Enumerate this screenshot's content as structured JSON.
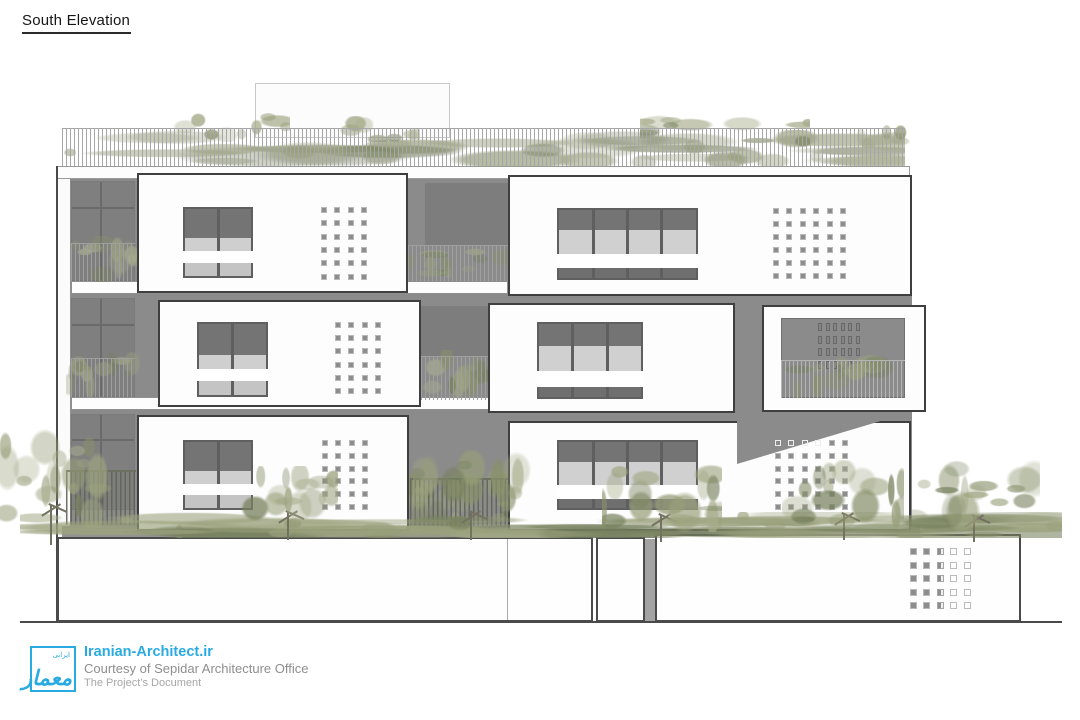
{
  "title": "South Elevation",
  "footer": {
    "site": "Iranian-Architect.ir",
    "courtesy": "Courtesy of Sepidar Architecture Office",
    "doc_label": "The Project’s Document",
    "logo_main": "معمار",
    "logo_small": "ایرانی"
  },
  "colors": {
    "accent": "#29abe2",
    "facade_gray": "#8b8b8b",
    "glazing_dark": "#747474",
    "glazing_light": "#d0d0d0",
    "panel_white": "#fdfdfd",
    "outline_dark": "#3f3f3f",
    "vegetation_olive": "#9aa17b",
    "ink": "#161616",
    "text_gray": "#8e8e8e",
    "text_light": "#a6a6a6"
  },
  "elevation": {
    "items": [
      {
        "t": "rect",
        "n": "roof-bulkhead",
        "x": 255,
        "y": 83,
        "w": 195,
        "h": 55,
        "f": "#fcfcfc",
        "s": "#c8c8c8",
        "sw": 1
      },
      {
        "t": "veg",
        "n": "roof-planting",
        "x": 60,
        "y": 130,
        "w": 845,
        "h": 36,
        "seed": 11,
        "nb": 40
      },
      {
        "t": "veg",
        "n": "roof-planting-bump",
        "x": 160,
        "y": 112,
        "w": 130,
        "h": 30,
        "seed": 21,
        "nb": 9
      },
      {
        "t": "veg",
        "n": "roof-planting-bump",
        "x": 330,
        "y": 116,
        "w": 90,
        "h": 26,
        "seed": 41,
        "nb": 7
      },
      {
        "t": "veg",
        "n": "roof-planting-bump",
        "x": 640,
        "y": 106,
        "w": 170,
        "h": 42,
        "seed": 31,
        "nb": 11
      },
      {
        "t": "veg",
        "n": "roof-planting-bump",
        "x": 855,
        "y": 120,
        "w": 60,
        "h": 28,
        "seed": 51,
        "nb": 5
      },
      {
        "t": "rail",
        "n": "roof-railing",
        "x": 62,
        "y": 128,
        "w": 843,
        "h": 39,
        "sp": 4,
        "c": "#a6a6a6"
      },
      {
        "t": "rect",
        "n": "roof-parapet",
        "x": 57,
        "y": 166,
        "w": 853,
        "h": 13,
        "f": "#fdfdfd",
        "s": "#9a9a9a",
        "sw": 1
      },
      {
        "t": "rect",
        "n": "left-edge-line",
        "x": 56,
        "y": 166,
        "w": 2,
        "h": 456,
        "f": "#4a4a4a"
      },
      {
        "t": "rect",
        "n": "left-side-wall",
        "x": 58,
        "y": 179,
        "w": 12,
        "h": 443,
        "f": "#fbfbfb"
      },
      {
        "t": "rect",
        "n": "left-side-wall-line",
        "x": 70,
        "y": 179,
        "w": 1,
        "h": 443,
        "f": "#8f8f8f"
      },
      {
        "t": "rect",
        "n": "facade-wall",
        "x": 71,
        "y": 179,
        "w": 841,
        "h": 353,
        "f": "#8b8b8b"
      },
      {
        "t": "glazing",
        "n": "balcony-glazing",
        "x": 71,
        "y": 181,
        "w": 64,
        "h": 100
      },
      {
        "t": "glazing",
        "n": "balcony-glazing",
        "x": 71,
        "y": 298,
        "w": 64,
        "h": 99
      },
      {
        "t": "glazing",
        "n": "balcony-glazing",
        "x": 71,
        "y": 414,
        "w": 64,
        "h": 96
      },
      {
        "t": "rect",
        "n": "recess-glazing",
        "x": 425,
        "y": 183,
        "w": 83,
        "h": 62,
        "f": "#7d7d7d"
      },
      {
        "t": "rect",
        "n": "recess-glazing",
        "x": 421,
        "y": 306,
        "w": 67,
        "h": 50,
        "f": "#7d7d7d"
      },
      {
        "t": "rect",
        "n": "floor-slab",
        "x": 71,
        "y": 281,
        "w": 437,
        "h": 13,
        "f": "#fdfdfd",
        "s": "#8f8f8f",
        "sw": 1
      },
      {
        "t": "rect",
        "n": "floor-slab",
        "x": 71,
        "y": 397,
        "w": 437,
        "h": 13,
        "f": "#fdfdfd",
        "s": "#8f8f8f",
        "sw": 1
      },
      {
        "t": "veg",
        "n": "balcony-planting",
        "x": 66,
        "y": 236,
        "w": 76,
        "h": 46,
        "seed": 61,
        "nb": 12
      },
      {
        "t": "rail",
        "n": "balcony-railing",
        "x": 71,
        "y": 243,
        "w": 64,
        "h": 38,
        "sp": 4,
        "c": "#9f9f9f"
      },
      {
        "t": "veg",
        "n": "balcony-planting",
        "x": 406,
        "y": 246,
        "w": 104,
        "h": 36,
        "seed": 71,
        "nb": 12
      },
      {
        "t": "rail",
        "n": "balcony-railing",
        "x": 408,
        "y": 245,
        "w": 100,
        "h": 36,
        "sp": 4,
        "c": "#9f9f9f"
      },
      {
        "t": "veg",
        "n": "balcony-planting",
        "x": 66,
        "y": 352,
        "w": 76,
        "h": 46,
        "seed": 81,
        "nb": 12
      },
      {
        "t": "rail",
        "n": "balcony-railing",
        "x": 71,
        "y": 358,
        "w": 64,
        "h": 39,
        "sp": 4,
        "c": "#9f9f9f"
      },
      {
        "t": "veg",
        "n": "balcony-planting",
        "x": 419,
        "y": 350,
        "w": 72,
        "h": 50,
        "seed": 91,
        "nb": 12
      },
      {
        "t": "rail",
        "n": "balcony-railing",
        "x": 421,
        "y": 356,
        "w": 67,
        "h": 44,
        "sp": 4,
        "c": "#9f9f9f"
      },
      {
        "t": "rect",
        "n": "ground-slab",
        "x": 62,
        "y": 526,
        "w": 858,
        "h": 12,
        "f": "#929292"
      },
      {
        "t": "veg",
        "n": "garden-planting",
        "x": 400,
        "y": 466,
        "w": 116,
        "h": 62,
        "seed": 101,
        "nb": 14
      },
      {
        "t": "fence",
        "n": "garden-fence",
        "x": 410,
        "y": 478,
        "w": 98,
        "h": 48
      },
      {
        "t": "fence",
        "n": "garden-fence",
        "x": 66,
        "y": 470,
        "w": 70,
        "h": 55
      },
      {
        "t": "rect",
        "n": "ground-wall-left",
        "x": 57,
        "y": 537,
        "w": 536,
        "h": 85,
        "f": "#fefefe",
        "s": "#4b4b4b",
        "sw": 2
      },
      {
        "t": "rect",
        "n": "ground-wall-joint",
        "x": 507,
        "y": 539,
        "w": 1,
        "h": 81,
        "f": "#ababab"
      },
      {
        "t": "rect",
        "n": "ground-wall-middle",
        "x": 596,
        "y": 537,
        "w": 49,
        "h": 85,
        "f": "#fefefe",
        "s": "#4b4b4b",
        "sw": 2
      },
      {
        "t": "rect",
        "n": "ground-wall-shadow-edge",
        "x": 645,
        "y": 539,
        "w": 10,
        "h": 83,
        "f": "#a3a3a3"
      },
      {
        "t": "rect",
        "n": "ground-wall-right",
        "x": 655,
        "y": 534,
        "w": 366,
        "h": 88,
        "f": "#fefefe",
        "s": "#4b4b4b",
        "sw": 2
      },
      {
        "t": "grid",
        "n": "perforation-grid-entrance",
        "x": 910,
        "y": 548,
        "cols": 5,
        "rows": 5,
        "px": 13.4,
        "py": 13.6,
        "s": 7,
        "colStyles": [
          "filled",
          "filled",
          "half",
          "outline",
          "outline"
        ]
      },
      {
        "t": "rect",
        "n": "ground-line",
        "x": 20,
        "y": 621,
        "w": 1042,
        "h": 2,
        "f": "#4a4a4a"
      },
      {
        "t": "panel",
        "n": "facade-panel",
        "x": 137,
        "y": 173,
        "w": 271,
        "h": 120
      },
      {
        "t": "window",
        "n": "window",
        "x": 183,
        "y": 207,
        "w": 70,
        "h": 71,
        "panes": 2
      },
      {
        "t": "grid",
        "n": "perforation-grid",
        "x": 321,
        "y": 207,
        "cols": 4,
        "rows": 6,
        "px": 13.3,
        "py": 13.3,
        "s": 6
      },
      {
        "t": "panel",
        "n": "facade-panel",
        "x": 508,
        "y": 175,
        "w": 404,
        "h": 121
      },
      {
        "t": "window",
        "n": "window",
        "x": 557,
        "y": 208,
        "w": 141,
        "h": 72,
        "panes": 4
      },
      {
        "t": "grid",
        "n": "perforation-grid",
        "x": 773,
        "y": 208,
        "cols": 6,
        "rows": 6,
        "px": 13.4,
        "py": 13,
        "s": 6
      },
      {
        "t": "panel",
        "n": "facade-panel",
        "x": 158,
        "y": 300,
        "w": 263,
        "h": 107
      },
      {
        "t": "window",
        "n": "window",
        "x": 197,
        "y": 322,
        "w": 71,
        "h": 75,
        "panes": 2
      },
      {
        "t": "grid",
        "n": "perforation-grid",
        "x": 335,
        "y": 322,
        "cols": 4,
        "rows": 6,
        "px": 13.3,
        "py": 13.2,
        "s": 6
      },
      {
        "t": "panel",
        "n": "facade-panel",
        "x": 488,
        "y": 303,
        "w": 247,
        "h": 110
      },
      {
        "t": "window",
        "n": "window",
        "x": 537,
        "y": 322,
        "w": 106,
        "h": 77,
        "panes": 3
      },
      {
        "t": "panel",
        "n": "facade-panel",
        "x": 762,
        "y": 305,
        "w": 164,
        "h": 107
      },
      {
        "t": "rect",
        "n": "loggia-opening",
        "x": 781,
        "y": 318,
        "w": 124,
        "h": 80,
        "f": "#8b8b8b",
        "s": "#707070",
        "sw": 1
      },
      {
        "t": "slotgrid",
        "n": "perforation-slots",
        "x": 818,
        "y": 323,
        "cols": 6,
        "rows": 4,
        "px": 7.6,
        "py": 12.6,
        "sw2": 4,
        "sh": 8
      },
      {
        "t": "veg",
        "n": "loggia-planting",
        "x": 781,
        "y": 352,
        "w": 124,
        "h": 46,
        "seed": 111,
        "nb": 14
      },
      {
        "t": "rail",
        "n": "loggia-railing",
        "x": 781,
        "y": 360,
        "w": 124,
        "h": 38,
        "sp": 4,
        "c": "#b5b5b5"
      },
      {
        "t": "panel",
        "n": "facade-panel",
        "x": 137,
        "y": 415,
        "w": 272,
        "h": 116
      },
      {
        "t": "window",
        "n": "window",
        "x": 183,
        "y": 440,
        "w": 70,
        "h": 70,
        "panes": 2
      },
      {
        "t": "grid",
        "n": "perforation-grid",
        "x": 322,
        "y": 440,
        "cols": 4,
        "rows": 6,
        "px": 13.3,
        "py": 12.8,
        "s": 6
      },
      {
        "t": "panel",
        "n": "facade-panel",
        "x": 508,
        "y": 421,
        "w": 403,
        "h": 110
      },
      {
        "t": "window",
        "n": "window",
        "x": 557,
        "y": 440,
        "w": 141,
        "h": 70,
        "panes": 4
      },
      {
        "t": "tri",
        "n": "shadow-triangle",
        "x": 737,
        "y": 420,
        "w": 147,
        "h": 44,
        "f": "#8b8b8b"
      },
      {
        "t": "grid",
        "n": "perforation-grid",
        "x": 775,
        "y": 440,
        "cols": 6,
        "rows": 6,
        "px": 13.4,
        "py": 12.8,
        "s": 6,
        "hollow": [
          [
            0,
            0
          ],
          [
            0,
            1
          ],
          [
            0,
            2
          ],
          [
            0,
            3
          ]
        ]
      },
      {
        "t": "veg",
        "n": "street-planting",
        "x": 20,
        "y": 512,
        "w": 1042,
        "h": 26,
        "seed": 121,
        "nb": 70
      },
      {
        "t": "tree",
        "n": "tree",
        "x": 0,
        "y": 428,
        "w": 112,
        "h": 100,
        "tx": 50,
        "ty": 505,
        "th": 40,
        "seed": 131,
        "nb": 20
      },
      {
        "t": "tree",
        "n": "tree",
        "x": 238,
        "y": 466,
        "w": 100,
        "h": 60,
        "tx": 287,
        "ty": 512,
        "th": 28,
        "seed": 141,
        "nb": 15
      },
      {
        "t": "tree",
        "n": "tree",
        "x": 413,
        "y": 450,
        "w": 118,
        "h": 76,
        "tx": 470,
        "ty": 512,
        "th": 28,
        "seed": 151,
        "nb": 17
      },
      {
        "t": "tree",
        "n": "tree",
        "x": 602,
        "y": 452,
        "w": 120,
        "h": 80,
        "tx": 660,
        "ty": 515,
        "th": 27,
        "seed": 161,
        "nb": 17
      },
      {
        "t": "tree",
        "n": "tree",
        "x": 782,
        "y": 460,
        "w": 122,
        "h": 70,
        "tx": 843,
        "ty": 514,
        "th": 26,
        "seed": 171,
        "nb": 16
      },
      {
        "t": "tree",
        "n": "tree",
        "x": 912,
        "y": 455,
        "w": 128,
        "h": 78,
        "tx": 973,
        "ty": 516,
        "th": 26,
        "seed": 181,
        "nb": 17
      }
    ]
  }
}
